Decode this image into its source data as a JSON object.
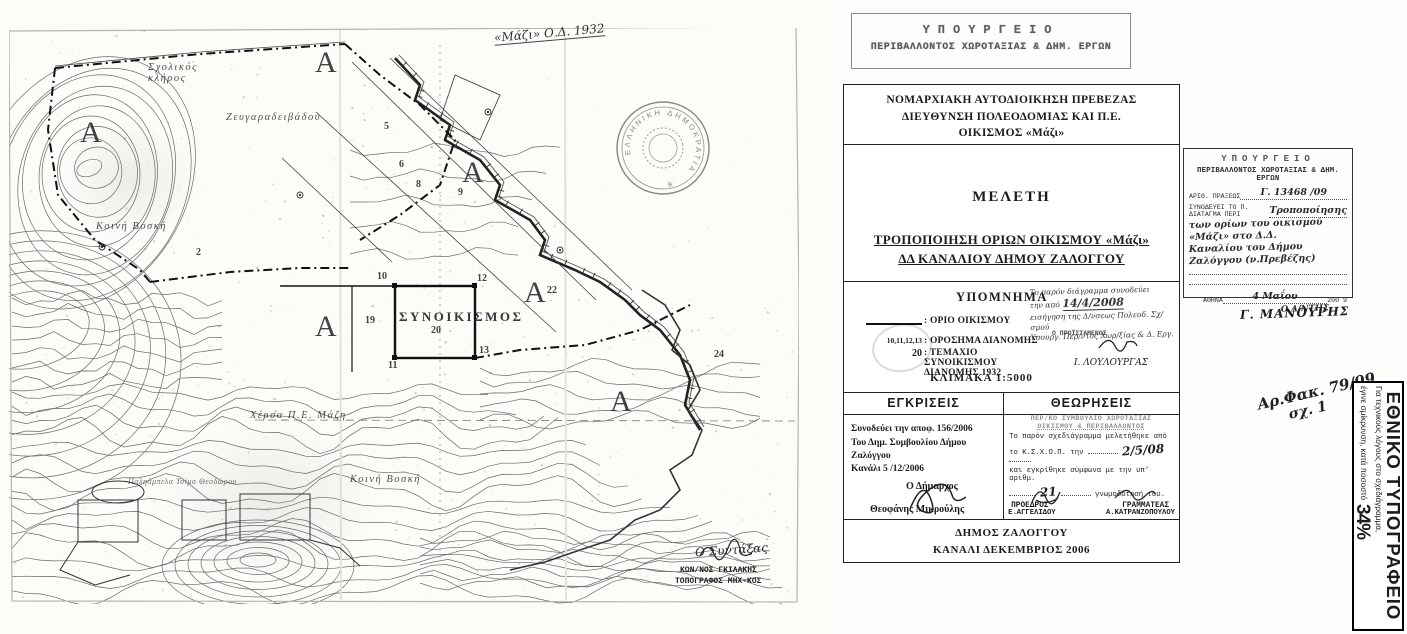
{
  "document": {
    "ministry_stamp_top": {
      "line1": "ΥΠΟΥΡΓΕΙΟ",
      "line2": "ΠΕΡΙΒΑΛΛΟΝΤΟΣ ΧΩΡΟΤΑΞΙΑΣ & ΔΗΜ. ΕΡΓΩΝ"
    },
    "header": {
      "line1": "ΝΟΜΑΡΧΙΑΚΗ ΑΥΤΟΔΙΟΙΚΗΣΗ ΠΡΕΒΕΖΑΣ",
      "line2": "ΔΙΕΥΘΥΝΣΗ ΠΟΛΕΟΔΟΜΙΑΣ ΚΑΙ Π.Ε.",
      "line3": "ΟΙΚΙΣΜΟΣ «Μάζι»"
    },
    "study": {
      "label": "ΜΕΛΕΤΗ",
      "title1": "ΤΡΟΠΟΠΟΙΗΣΗ ΟΡΙΩΝ ΟΙΚΙΣΜΟΥ «Μάζι»",
      "title2": "ΔΔ ΚΑΝΑΛΙΟΥ  ΔΗΜΟΥ ΖΑΛΟΓΓΟΥ"
    },
    "legend": {
      "heading": "ΥΠΟΜΝΗΜΑ",
      "items": [
        {
          "symbol": "",
          "label": ": ΟΡΙΟ ΟΙΚΙΣΜΟΥ"
        },
        {
          "symbol": "10,11,12,13",
          "label": ": ΟΡΟΣΗΜΑ ΔΙΑΝΟΜΗΣ"
        },
        {
          "symbol": "20",
          "label": ": ΤΕΜΑΧΙΟ ΣΥΝΟΙΚΙΣΜΟΥ ΔΙΑΝΟΜΗΣ 1932"
        }
      ],
      "scale": "ΚΛΙΜΑΚΑ  1:5000",
      "note": {
        "l1": "Το παρόν διάγραμμα συνοδεύει",
        "l2pre": "την από",
        "l2date": "14/4/2008",
        "l3": "εισήγηση της Δ/νσεως Πολεοδ. Σχ/σμού",
        "l4": "Υπουργ. Περ/ντος Χωρ/ξίας & Δ. Εργ.",
        "approver": "Ο ΠΡΟΪΣΤΑΜΕΝΟΣ",
        "signature": "Ι. ΛΟΥΛΟΥΡΓΑΣ"
      }
    },
    "approvals": {
      "heading": "ΕΓΚΡΙΣΕΙΣ",
      "l1": "Συνοδεύει την αποφ.  156/2006",
      "l2": "Του Δημ. Συμβουλίου Δήμου Ζαλόγγου",
      "l3": "Κανάλι  5 /12/2006",
      "role": "Ο Δήμαρχος",
      "name": "Θεοφάνης Μικρούλης"
    },
    "validations": {
      "heading": "ΘΕΩΡΗΣΕΙΣ",
      "stamp1": "ΠΕΡ/ΚΟ ΣΥΜΒΟΥΛΙΟ ΧΩΡΟΤΑΞΙΑΣ",
      "stamp2": "ΟΙΚΙΣΜΟΥ & ΠΕΡΙΒΑΛΛΟΝΤΟΣ",
      "b1": "Το παρόν σχεδιάγραμμα μελετήθηκε από",
      "b2pre": "το Κ.Σ.Χ.Ο.Π. την",
      "b2date": "2/5/08",
      "b3": "και εγκρίθηκε σύμφωνα με την υπ’ αριθμ.",
      "b4num": "21",
      "b4post": "γνωμοδότησή του.",
      "role1": "ΠΡΟΕΔΡΟΣ",
      "role2": "ΓΡΑΜΜΑΤΕΑΣ",
      "name1": "Ε.ΑΓΓΕΛΙΔΟΥ",
      "name2": "Α.ΚΑΤΡΑΝΖΟΠΟΥΛΟΥ"
    },
    "footer": {
      "line1": "ΔΗΜΟΣ ΖΑΛΟΓΓΟΥ",
      "line2": "ΚΑΝΑΛΙ  ΔΕΚΕΜΒΡΙΟΣ 2006"
    }
  },
  "ministry_stamp_right": {
    "title": "ΥΠΟΥΡΓΕΙΟ",
    "subtitle": "ΠΕΡΙΒΑΛΛΟΝΤΟΣ ΧΩΡΟΤΑΞΙΑΣ & ΔΗΜ. ΕΡΓΩΝ",
    "praxis_label": "ΑΡΙΘ. ΠΡΑΞΕΩΣ",
    "praxis_value": "Γ. 13468 /09",
    "accompanies": "ΣΥΝΟΔΕΥΕΙ ΤΟ Π. ΔΙΑΤΑΓΜΑ ΠΕΡΙ",
    "hand1": "Τροποποίησης",
    "hand2": "των ορίων του οικισμού «Μάζι» στο Δ.Δ.",
    "hand3": "Καναλίου του Δήμου Ζαλόγγου (ν.Πρεβέζης)",
    "city": "ΑΘΗΝΑ",
    "hand_date": "4 Μαΐου",
    "year": "200 9",
    "director": "Ο Δ/ΝΤΗΣ",
    "signer": "Γ. ΜΑΝΟΥΡΗΣ"
  },
  "file_note": {
    "line1": "Αρ.Φακ. 79/09",
    "line2": "σχ. 1"
  },
  "printing_office": {
    "name": "ΕΘΝΙΚΟ ΤΥΠΟΓΡΑΦΕΙΟ",
    "note1": "Για τεχνικούς λόγους στο σχεδιάγραμμα,",
    "note2": "έγινε σμίκρυνση, κατά ποσοστό",
    "percent": "34%"
  },
  "map": {
    "annotation_top": "«Μάζι» Ο.Δ. 1932",
    "seal_text": "ΕΛΛΗΝΙΚΗ ΔΗΜΟΚΡΑΤΙΑ",
    "surveyor_note": "Ο Συντάξας",
    "surveyor_name": "ΚΩΝ/ΝΟΣ ΓΚΙΛΑΚΗΣ",
    "surveyor_title": "ΤΟΠΟΓΡΑΦΟΣ ΜΗΧ-ΚΟΣ",
    "labels": [
      {
        "t": "Σχολικός\nκλήρος",
        "x": 148,
        "y": 62,
        "c": "pl"
      },
      {
        "t": "Ζευγαραδειβάδου",
        "x": 226,
        "y": 112,
        "c": "pl"
      },
      {
        "t": "Κοινή Βοσκή",
        "x": 96,
        "y": 221,
        "c": "pl"
      },
      {
        "t": "Χέρσα Π.Ε. Μάζη",
        "x": 250,
        "y": 410,
        "c": "pl"
      },
      {
        "t": "Κοινή Βοσκή",
        "x": 350,
        "y": 474,
        "c": "pl"
      },
      {
        "t": "Παληάμπελα Τσίμα Θεοδώρου",
        "x": 128,
        "y": 477,
        "c": "pl tinypl"
      },
      {
        "t": "ΣΥΝΟΙΚΙΣΜΟΣ",
        "x": 399,
        "y": 309,
        "c": "settle"
      },
      {
        "t": "20",
        "x": 431,
        "y": 325,
        "c": "num"
      },
      {
        "t": "10",
        "x": 377,
        "y": 271,
        "c": "num"
      },
      {
        "t": "11",
        "x": 388,
        "y": 360,
        "c": "num"
      },
      {
        "t": "12",
        "x": 477,
        "y": 273,
        "c": "num"
      },
      {
        "t": "13",
        "x": 479,
        "y": 345,
        "c": "num"
      },
      {
        "t": "19",
        "x": 365,
        "y": 315,
        "c": "num"
      },
      {
        "t": "22",
        "x": 547,
        "y": 285,
        "c": "num"
      },
      {
        "t": "2",
        "x": 196,
        "y": 247,
        "c": "num"
      },
      {
        "t": "24",
        "x": 714,
        "y": 349,
        "c": "num"
      },
      {
        "t": "5",
        "x": 384,
        "y": 121,
        "c": "num"
      },
      {
        "t": "6",
        "x": 399,
        "y": 159,
        "c": "num"
      },
      {
        "t": "8",
        "x": 416,
        "y": 179,
        "c": "num"
      },
      {
        "t": "9",
        "x": 458,
        "y": 187,
        "c": "num"
      },
      {
        "t": "Α",
        "x": 80,
        "y": 116,
        "c": "bigA"
      },
      {
        "t": "Α",
        "x": 315,
        "y": 46,
        "c": "bigA"
      },
      {
        "t": "Α",
        "x": 462,
        "y": 156,
        "c": "bigA"
      },
      {
        "t": "Α",
        "x": 524,
        "y": 276,
        "c": "bigA"
      },
      {
        "t": "Α",
        "x": 315,
        "y": 310,
        "c": "bigA"
      },
      {
        "t": "Α",
        "x": 610,
        "y": 385,
        "c": "bigA"
      }
    ]
  }
}
